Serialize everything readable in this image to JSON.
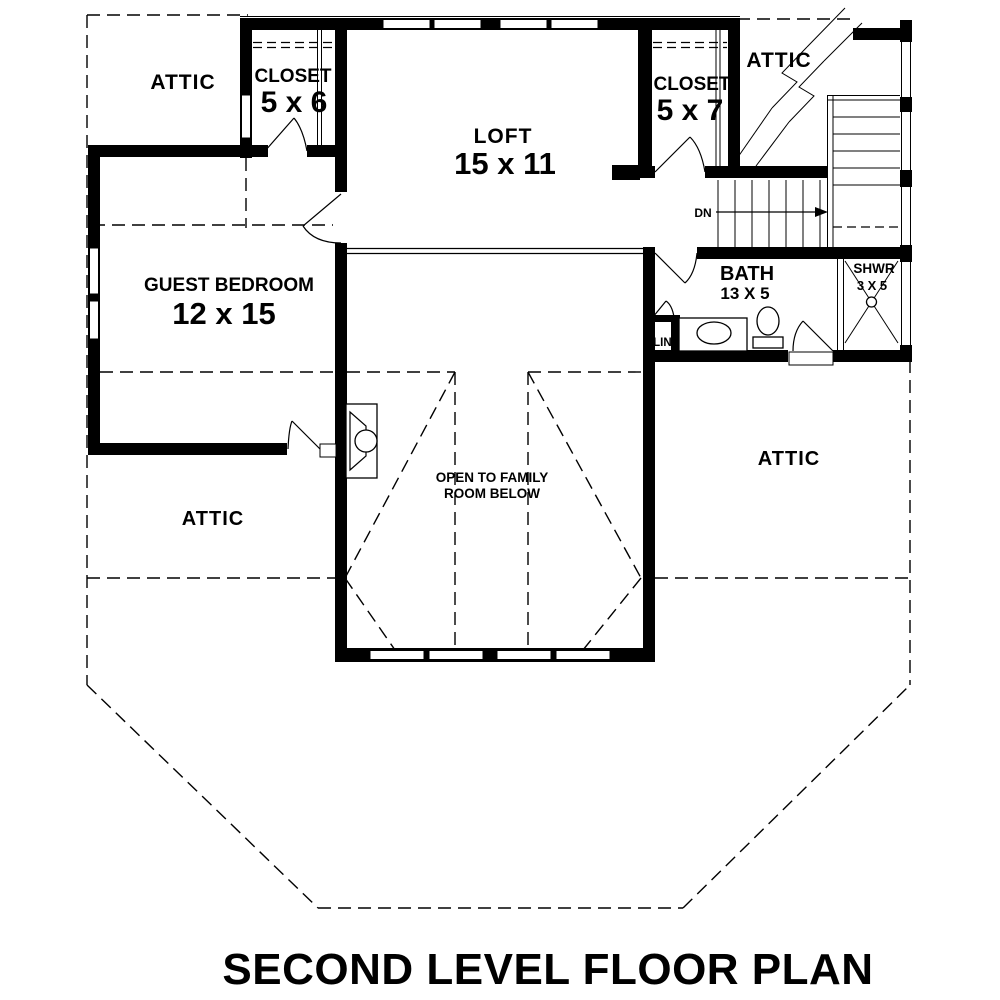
{
  "title": "SECOND LEVEL FLOOR PLAN",
  "labels": {
    "attic_top_left": "ATTIC",
    "attic_top_right": "ATTIC",
    "attic_bottom_left": "ATTIC",
    "attic_bottom_right": "ATTIC",
    "closet_left": {
      "name": "CLOSET",
      "dims": "5 x 6"
    },
    "closet_right": {
      "name": "CLOSET",
      "dims": "5 x 7"
    },
    "loft": {
      "name": "LOFT",
      "dims": "15 x 11"
    },
    "guest_bedroom": {
      "name": "GUEST BEDROOM",
      "dims": "12 x 15"
    },
    "bath": {
      "name": "BATH",
      "dims": "13 X 5"
    },
    "shower": {
      "name": "SHWR",
      "dims": "3 X 5"
    },
    "linen": "LIN.",
    "stairs_down": "DN",
    "open_to_below_line1": "OPEN TO FAMILY",
    "open_to_below_line2": "ROOM BELOW"
  },
  "colors": {
    "ink": "#000000",
    "bg": "#ffffff"
  }
}
